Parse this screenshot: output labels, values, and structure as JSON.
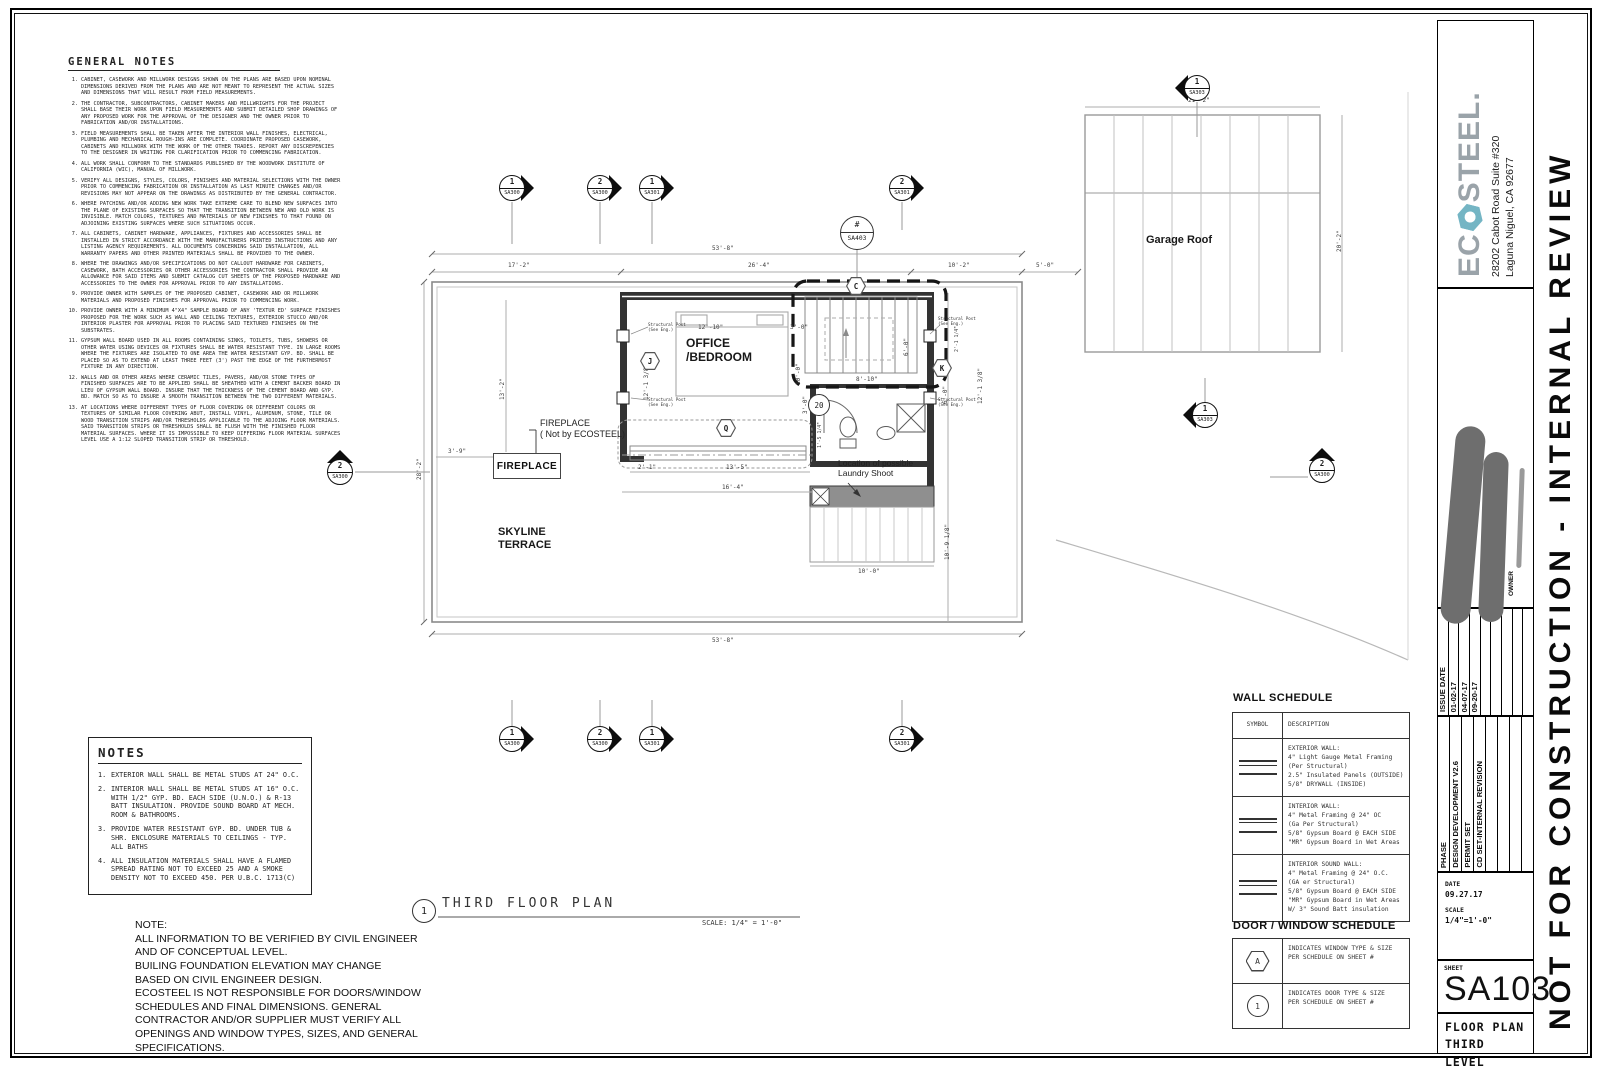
{
  "general_notes": {
    "title": "GENERAL NOTES",
    "items": [
      "CABINET, CASEWORK AND MILLWORK DESIGNS SHOWN ON THE PLANS ARE BASED UPON NOMINAL DIMENSIONS DERIVED FROM THE PLANS AND ARE NOT MEANT TO REPRESENT THE ACTUAL SIZES AND DIMENSIONS THAT WILL RESULT FROM FIELD MEASUREMENTS.",
      "THE CONTRACTOR, SUBCONTRACTORS, CABINET MAKERS AND MILLWRIGHTS FOR THE PROJECT SHALL BASE THEIR WORK UPON FIELD MEASUREMENTS AND SUBMIT DETAILED SHOP DRAWINGS OF ANY PROPOSED WORK FOR THE APPROVAL OF THE DESIGNER AND THE OWNER PRIOR TO FABRICATION AND/OR INSTALLATIONS.",
      "FIELD MEASUREMENTS SHALL BE TAKEN AFTER THE INTERIOR WALL FINISHES, ELECTRICAL, PLUMBING AND MECHANICAL ROUGH-INS ARE COMPLETE. COORDINATE PROPOSED CASEWORK, CABINETS AND MILLWORK WITH THE WORK OF THE OTHER TRADES. REPORT ANY DISCREPENCIES TO THE DESIGNER IN WRITING FOR CLARIFICATION PRIOR TO COMMENCING FABRICATION.",
      "ALL WORK SHALL CONFORM TO THE STANDARDS PUBLISHED BY THE WOODWORK INSTITUTE OF CALIFORNIA (WIC), MANUAL OF MILLWORK.",
      "VERIFY ALL DESIGNS, STYLES, COLORS, FINISHES AND MATERIAL SELECTIONS WITH THE OWNER PRIOR TO COMMENCING FABRICATION OR INSTALLATION AS LAST MINUTE CHANGES AND/OR REVISIONS MAY NOT APPEAR ON THE DRAWINGS AS DISTRIBUTED BY THE GENERAL CONTRACTOR.",
      "WHERE PATCHING AND/OR ADDING NEW WORK TAKE EXTREME CARE TO BLEND NEW SURFACES INTO THE PLANE OF EXISTING SURFACES SO THAT THE TRANSITION BETWEEN NEW AND OLD WORK IS INVISIBLE. MATCH COLORS, TEXTURES AND MATERIALS OF NEW FINISHES TO THAT FOUND ON ADJOINING EXISTING SURFACES WHERE SUCH SITUATIONS OCCUR.",
      "ALL CABINETS, CABINET HARDWARE, APPLIANCES, FIXTURES AND ACCESSORIES SHALL BE INSTALLED IN STRICT ACCORDANCE WITH THE MANUFACTURERS PRINTED INSTRUCTIONS AND ANY LISTING AGENCY REQUIREMENTS. ALL DOCUMENTS CONCERNING SAID INSTALLATION, ALL WARRANTY PAPERS AND OTHER PRINTED MATERIALS SHALL BE PROVIDED TO THE OWNER.",
      "WHERE THE DRAWINGS AND/OR SPECIFICATIONS DO NOT CALLOUT HARDWARE FOR CABINETS, CASEWORK, BATH ACCESSORIES OR OTHER ACCESSORIES THE CONTRACTOR SHALL PROVIDE AN ALLOWANCE FOR SAID ITEMS AND SUBMIT CATALOG CUT SHEETS OF THE PROPOSED HARDWARE AND ACCESSORIES TO THE OWNER FOR APPROVAL PRIOR TO ANY INSTALLATIONS.",
      "PROVIDE OWNER WITH SAMPLES OF THE PROPOSED CABINET, CASEWORK AND OR MILLWORK MATERIALS AND PROPOSED FINISHES FOR APPROVAL PRIOR TO COMMENCING WORK.",
      "PROVIDE OWNER WITH A MINIMUM 4\"X4\" SAMPLE BOARD OF ANY 'TEXTUR ED' SURFACE FINISHES PROPOSED FOR THE WORK SUCH AS WALL AND CEILING TEXTURES, EXTERIOR STUCCO AND/OR INTERIOR PLASTER FOR APPROVAL PRIOR TO PLACING SAID TEXTURED FINISHES ON THE SUBSTRATES.",
      "GYPSUM WALL BOARD USED IN ALL ROOMS CONTAINING SINKS, TOILETS, TUBS, SHOWERS OR OTHER WATER USING DEVICES OR FIXTURES SHALL BE WATER RESISTANT TYPE. IN LARGE ROOMS WHERE THE FIXTURES ARE ISOLATED TO ONE AREA THE WATER RESISTANT GYP. BD. SHALL BE PLACED SO AS TO EXTEND AT LEAST THREE FEET (3') PAST THE EDGE OF THE FURTHERMOST FIXTURE IN ANY DIRECTION.",
      "WALLS AND OR OTHER AREAS WHERE CERAMIC TILES, PAVERS, AND/OR STONE TYPES OF FINISHED SURFACES ARE TO BE APPLIED SHALL BE SHEATHED WITH A CEMENT BACKER BOARD IN LIEU OF GYPSUM WALL BOARD. INSURE THAT THE THICKNESS OF THE CEMENT BOARD AND GYP. BD. MATCH SO AS TO INSURE A SMOOTH TRANSITION BETWEEN THE TWO DIFFERENT MATERIALS.",
      "AT LOCATIONS WHERE DIFFERENT TYPES OF FLOOR COVERING OR DIFFERENT COLORS OR TEXTURES OF SIMILAR FLOOR COVERING ABUT, INSTALL VINYL, ALUMINUM, STONE, TILE OR WOOD TRANSITION STRIPS AND/OR THRESHOLDS APPLICABLE TO THE ADJOING FLOOR MATERIALS. SAID TRANSITION STRIPS OR THRESHOLDS SHALL BE FLUSH WITH THE FINISHED FLOOR MATERIAL SURFACES. WHERE IT IS IMPOSSIBLE TO KEEP DIFFERING FLOOR MATERIAL SURFACES LEVEL USE A 1:12 SLOPED TRANSITION STRIP OR THRESHOLD."
    ]
  },
  "notes_box": {
    "title": "NOTES",
    "items": [
      "EXTERIOR WALL SHALL BE METAL STUDS AT 24\" O.C.",
      "INTERIOR WALL SHALL BE METAL STUDS AT 16\" O.C. WITH 1/2\" GYP. BD. EACH SIDE (U.N.O.) & R-13 BATT INSULATION. PROVIDE SOUND BOARD AT MECH. ROOM & BATHROOMS.",
      "PROVIDE WATER RESISTANT GYP. BD. UNDER TUB & SHR. ENCLOSURE MATERIALS TO CEILINGS - TYP. ALL BATHS",
      "ALL INSULATION MATERIALS SHALL HAVE A FLAMED SPREAD RATING NOT TO EXCEED 25 AND A SMOKE DENSITY NOT TO EXCEED 450. PER U.B.C. 1713(C)"
    ]
  },
  "note_para": {
    "lines": [
      "NOTE:",
      "ALL INFORMATION TO BE VERIFIED BY CIVIL ENGINEER",
      "AND OF CONCEPTUAL LEVEL.",
      "BUILING FOUNDATION ELEVATION MAY CHANGE",
      "BASED ON CIVIL ENGINEER DESIGN.",
      "ECOSTEEL IS NOT RESPONSIBLE FOR DOORS/WINDOW",
      "SCHEDULES AND FINAL DIMENSIONS. GENERAL",
      "CONTRACTOR AND/OR SUPPLIER MUST VERIFY ALL",
      "OPENINGS AND WINDOW TYPES, SIZES, AND GENERAL",
      "SPECIFICATIONS."
    ]
  },
  "plan": {
    "labels": {
      "office_line1": "OFFICE",
      "office_line2": "/BEDROOM",
      "skyline_line1": "SKYLINE",
      "skyline_line2": "TERRACE",
      "fireplace_box": "FIREPLACE",
      "fireplace_callout_line1": "FIREPLACE",
      "fireplace_callout_line2": "( Not by ECOSTEEL)",
      "garage": "Garage Roof",
      "laundry_line1": "Location of possible",
      "laundry_line2": "Laundry Shoot",
      "post_line1": "Structural Post",
      "post_line2": "(See Eng.)"
    },
    "title": {
      "number": "1",
      "text": "THIRD FLOOR PLAN",
      "scale": "SCALE: 1/4\" = 1'-0\""
    },
    "door_num": "20",
    "hex": {
      "j": "J",
      "q": "Q",
      "k": "K",
      "c": "C"
    },
    "callout": {
      "num": "#",
      "sheet": "SA403"
    },
    "markers": [
      {
        "num": "1",
        "sheet": "SA300"
      },
      {
        "num": "2",
        "sheet": "SA300"
      },
      {
        "num": "1",
        "sheet": "SA301"
      },
      {
        "num": "2",
        "sheet": "SA301"
      },
      {
        "num": "1",
        "sheet": "SA300"
      },
      {
        "num": "2",
        "sheet": "SA300"
      },
      {
        "num": "1",
        "sheet": "SA301"
      },
      {
        "num": "2",
        "sheet": "SA301"
      },
      {
        "num": "2",
        "sheet": "SA300"
      },
      {
        "num": "1",
        "sheet": "SA303"
      },
      {
        "num": "2",
        "sheet": "SA300"
      },
      {
        "num": "1",
        "sheet": "SA303"
      }
    ],
    "dims": {
      "top_total": "53'-8\"",
      "top_seg1": "17'-2\"",
      "top_seg2": "26'-4\"",
      "top_seg3": "10'-2\"",
      "top_seg4": "5'-0\"",
      "bottom_total": "53'-8\"",
      "left_height": "28'-2\"",
      "left_inner": "13'-2\"",
      "fireplace_offset": "3'-9\"",
      "room_width": "12'-10\"",
      "stair_offset": "3'-0\"",
      "room_height_left": "12'-1 3/8\"",
      "room_height_right": "12'-1 3/8\"",
      "interior_10": "10'-0\"",
      "interior_3": "3'-0\"",
      "stair_width": "8'-10\"",
      "stair_height": "6'-0\"",
      "right_6": "6'-0\"",
      "right_lower": "10'-9 1/8\"",
      "bath_small": "1'-5 1/4\"",
      "corner_small": "2'-1 1/4\"",
      "bay_offset": "2'-1\"",
      "bay_width": "13'-5\"",
      "bay_total": "16'-4\"",
      "deck_width": "10'-0\"",
      "garage_width": "21'-2\"",
      "garage_height": "20'-2\""
    }
  },
  "wall_schedule": {
    "title": "WALL SCHEDULE",
    "col_symbol": "SYMBOL",
    "col_desc": "DESCRIPTION",
    "rows": [
      {
        "desc": "EXTERIOR WALL:\n4\" Light Gauge Metal Framing\n(Per Structural)\n2.5\" Insulated Panels (OUTSIDE)\n5/8\" DRYWALL (INSIDE)"
      },
      {
        "desc": "INTERIOR WALL:\n4\" Metal Framing @ 24\" OC\n(Ga Per Structural)\n5/8\" Gypsum Board @ EACH SIDE\n\"MR\" Gypsum Board in Wet Areas"
      },
      {
        "desc": "INTERIOR SOUND WALL:\n4\" Metal Framing @ 24\" O.C.\n(GA er Structural)\n5/8\" Gypsum Board @ EACH SIDE\n\"MR\" Gypsum Board in Wet Areas\nW/ 3\" Sound Batt insulation"
      }
    ]
  },
  "door_window_schedule": {
    "title": "DOOR / WINDOW SCHEDULE",
    "rows": [
      {
        "symbol": "A",
        "desc": "INDICATES WINDOW TYPE & SIZE\nPER SCHEDULE ON SHEET #"
      },
      {
        "symbol": "1",
        "desc": "INDICATES DOOR TYPE & SIZE\nPER SCHEDULE ON SHEET #"
      }
    ]
  },
  "title_block": {
    "logo_prefix": "EC",
    "logo_suffix": "STEEL.",
    "address_line1": "28202 Cabot Road Suite #320",
    "address_line2": "Laguna Niguel, CA 92677",
    "owner_label": "OWNER",
    "issue_header": "ISSUE DATE",
    "issue_dates": [
      "01-02-17",
      "04-07-17",
      "09-20-17"
    ],
    "phase_header": "PHASE",
    "phases": [
      "DESIGN DEVELOPMENT V2.6",
      "PERMIT SET",
      "CD SET-INTERNAL REVISION"
    ],
    "date_label": "DATE",
    "date_value": "09.27.17",
    "scale_label": "SCALE",
    "scale_value": "1/4\"=1'-0\"",
    "sheet_label": "SHEET",
    "sheet_value": "SA103",
    "drawing_title_line1": "FLOOR PLAN",
    "drawing_title_line2": "THIRD LEVEL",
    "watermark": "NOT FOR CONSTRUCTION - INTERNAL REVIEW",
    "colors": {
      "logo_gray": "#9aa3a9",
      "logo_teal": "#74b5c4"
    }
  }
}
